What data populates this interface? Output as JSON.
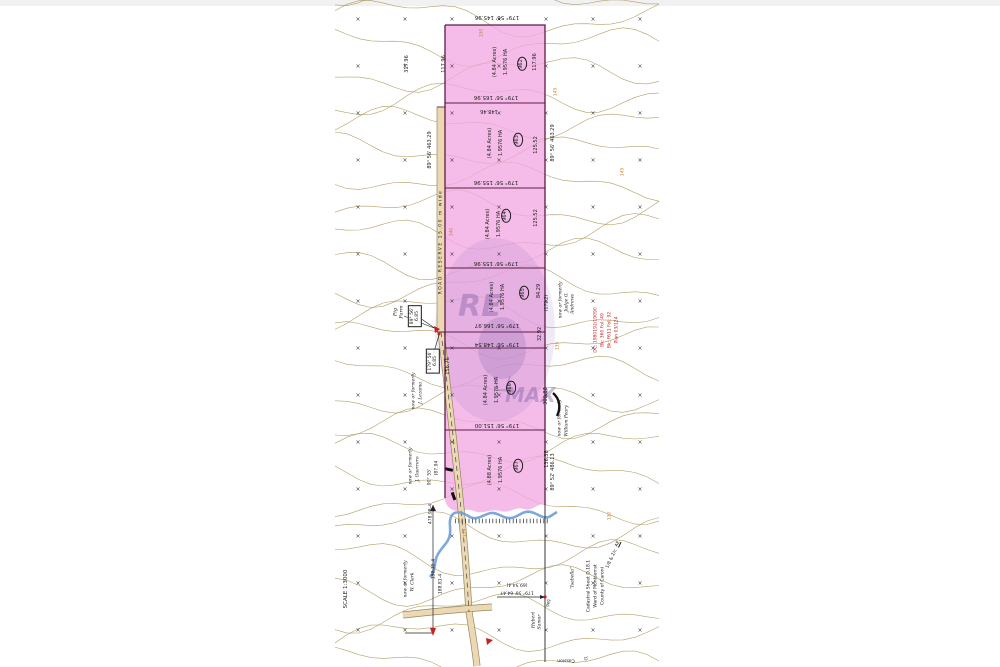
{
  "document_type": "cadastral subdivision survey plan",
  "colors": {
    "ink": "#1c1c1c",
    "red": "#c42222",
    "orange": "#c87d2a",
    "contour": "#a5914f",
    "lot_fill": "#f2a9e3",
    "boundary": "#5e1b47",
    "road_fill": "#ecd9b3",
    "road_edge": "#8a7a50",
    "stream": "#6f9fd8",
    "watermark": "#7d5ca8"
  },
  "watermark": {
    "re": "RE",
    "max": "MAX"
  },
  "grid": {
    "mark": "×",
    "x0": 358,
    "y0": 21,
    "dx": 47,
    "dy": 47,
    "cols": 7,
    "rows": 14
  },
  "annotations": {
    "boundary_dims": [
      {
        "t": "179° 56'  145.96",
        "x": 497,
        "y": 17
      },
      {
        "t": "179° 56'  165.96",
        "x": 496,
        "y": 97
      },
      {
        "t": "148.46",
        "x": 489,
        "y": 110,
        "s": 5
      },
      {
        "t": "179° 56'  155.96",
        "x": 496,
        "y": 182
      },
      {
        "t": "179° 56'  155.96",
        "x": 496,
        "y": 263
      },
      {
        "t": "179° 56'  166.97",
        "x": 497,
        "y": 325
      },
      {
        "t": "179° 56'  148.54",
        "x": 497,
        "y": 344
      },
      {
        "t": "179° 56'  151.00",
        "x": 497,
        "y": 425
      },
      {
        "t": "(69.54-4)",
        "x": 517,
        "y": 584,
        "s": 4.5
      },
      {
        "t": "179° 56'  64.47",
        "x": 517,
        "y": 592,
        "s": 4.5
      },
      {
        "t": "Cassion",
        "x": 566,
        "y": 660,
        "s": 4.5
      }
    ],
    "side_dims": [
      {
        "t": "317.96",
        "x": 408,
        "y": 64
      },
      {
        "t": "117.96",
        "x": 445,
        "y": 64
      },
      {
        "t": "117.96",
        "x": 536,
        "y": 62
      },
      {
        "t": "89° 56'  463.29",
        "x": 431,
        "y": 150
      },
      {
        "t": "125.52",
        "x": 537,
        "y": 145
      },
      {
        "t": "89° 56'  463.29",
        "x": 554,
        "y": 143
      },
      {
        "t": "125.52",
        "x": 537,
        "y": 218
      },
      {
        "t": "84.29",
        "x": 540,
        "y": 291
      },
      {
        "t": "(172.2)",
        "x": 547,
        "y": 303,
        "s": 4.5
      },
      {
        "t": "32.92",
        "x": 541,
        "y": 334
      },
      {
        "t": "156.76",
        "x": 449,
        "y": 366
      },
      {
        "t": "300.80",
        "x": 547,
        "y": 396
      },
      {
        "t": "136.38",
        "x": 548,
        "y": 459
      },
      {
        "t": "89° 52'  486.13",
        "x": 554,
        "y": 472
      },
      {
        "t": "478.98-4",
        "x": 431,
        "y": 514,
        "s": 4.5
      },
      {
        "t": "152.39-4",
        "x": 434,
        "y": 569,
        "s": 4.5
      },
      {
        "t": "188.81-4",
        "x": 441,
        "y": 584,
        "s": 4.5
      },
      {
        "t": "(87.94",
        "x": 437,
        "y": 468,
        "s": 4.5
      },
      {
        "t": "90° 55'",
        "x": 430,
        "y": 477,
        "s": 4.5
      },
      {
        "t": "Peg",
        "x": 549,
        "y": 603,
        "s": 4
      }
    ],
    "lot_areas": [
      {
        "t": "1.9576 HA",
        "x": 507,
        "y": 62
      },
      {
        "t": "(4.84 Acres)",
        "x": 496,
        "y": 62
      },
      {
        "t": "1.9576 HA",
        "x": 502,
        "y": 143
      },
      {
        "t": "(4.84 Acres)",
        "x": 491,
        "y": 143
      },
      {
        "t": "1.9576 HA",
        "x": 500,
        "y": 224
      },
      {
        "t": "(4.84 Acres)",
        "x": 489,
        "y": 224
      },
      {
        "t": "1.9576 HA",
        "x": 504,
        "y": 297
      },
      {
        "t": "(4.84 Acres)",
        "x": 493,
        "y": 297
      },
      {
        "t": "1.9576 HA",
        "x": 498,
        "y": 390
      },
      {
        "t": "(4.84 Acres)",
        "x": 487,
        "y": 390
      },
      {
        "t": "1.9576 HA",
        "x": 502,
        "y": 470
      },
      {
        "t": "(4.88 Acres)",
        "x": 491,
        "y": 470
      }
    ],
    "lot_numbers": [
      {
        "t": "962",
        "x": 522,
        "y": 64
      },
      {
        "t": "963",
        "x": 518,
        "y": 140
      },
      {
        "t": "964",
        "x": 506,
        "y": 216
      },
      {
        "t": "965",
        "x": 524,
        "y": 293
      },
      {
        "t": "966",
        "x": 511,
        "y": 388
      },
      {
        "t": "967",
        "x": 518,
        "y": 466
      }
    ],
    "boxed_dims": [
      {
        "t": "89° 56'",
        "t2": "6.85",
        "x": 415,
        "y": 316
      },
      {
        "t": "179° 56'",
        "t2": "6.85",
        "x": 433,
        "y": 361
      }
    ],
    "neighbors": [
      {
        "t": "Pig",
        "t2": "Farm",
        "x": 399,
        "y": 312,
        "s": 5
      },
      {
        "t": "now or formerly",
        "x": 414,
        "y": 391
      },
      {
        "t": "J. Lezama",
        "x": 421,
        "y": 393
      },
      {
        "t": "now or formerly",
        "x": 561,
        "y": 300
      },
      {
        "t": "Judge G.",
        "x": 567,
        "y": 302
      },
      {
        "t": "Andrews",
        "x": 573,
        "y": 304
      },
      {
        "t": "now or formerly",
        "x": 560,
        "y": 418
      },
      {
        "t": "William Peary",
        "x": 567,
        "y": 421
      },
      {
        "t": "now or formerly",
        "x": 411,
        "y": 466
      },
      {
        "t": "J. Guerrero",
        "x": 418,
        "y": 469
      },
      {
        "t": "now or formerly",
        "x": 406,
        "y": 579
      },
      {
        "t": "W. Clark",
        "x": 413,
        "y": 582
      },
      {
        "t": "Hubert",
        "x": 534,
        "y": 620
      },
      {
        "t": "Samar",
        "x": 540,
        "y": 622
      },
      {
        "t": "\"Isabella\"",
        "x": 573,
        "y": 578
      },
      {
        "t": "G.",
        "x": 587,
        "y": 658
      }
    ],
    "deed_refs": [
      {
        "t": "DC: 1980192/19090",
        "x": 596,
        "y": 330
      },
      {
        "t": "Bk: 360 Fol: 49",
        "x": 603,
        "y": 330
      },
      {
        "t": "Bk: F611 Fol: 92",
        "x": 610,
        "y": 330
      },
      {
        "t": "Plan 03/124",
        "x": 617,
        "y": 330
      }
    ],
    "footer": [
      {
        "t": "Cadastral Sheet  D.18.1",
        "x": 589,
        "y": 586
      },
      {
        "t": "Ward of Montserrat",
        "x": 596,
        "y": 586
      },
      {
        "t": "County of Caroni",
        "x": 603,
        "y": 586
      },
      {
        "t": "1/8 & 2/c",
        "x": 612,
        "y": 559,
        "r": -65
      },
      {
        "t": "AE",
        "x": 618,
        "y": 544,
        "r": -65,
        "k": "ul"
      }
    ],
    "elevations": [
      {
        "t": "150",
        "x": 482,
        "y": 33
      },
      {
        "t": "145",
        "x": 556,
        "y": 92
      },
      {
        "t": "145",
        "x": 623,
        "y": 172
      },
      {
        "t": "140",
        "x": 452,
        "y": 232
      },
      {
        "t": "135",
        "x": 558,
        "y": 346
      },
      {
        "t": "130",
        "x": 610,
        "y": 516
      },
      {
        "t": "125",
        "x": 466,
        "y": 533
      }
    ],
    "misc": [
      {
        "t": "ROAD RESERVE 15.00 m wide",
        "x": 441,
        "y": 242,
        "r": -90,
        "s": 4.5,
        "k": "sp",
        "n": "road-reserve-label"
      },
      {
        "t": "SCALE 1:3000",
        "x": 346,
        "y": 589,
        "r": -90,
        "s": 5.5,
        "n": "scale-label"
      }
    ]
  }
}
